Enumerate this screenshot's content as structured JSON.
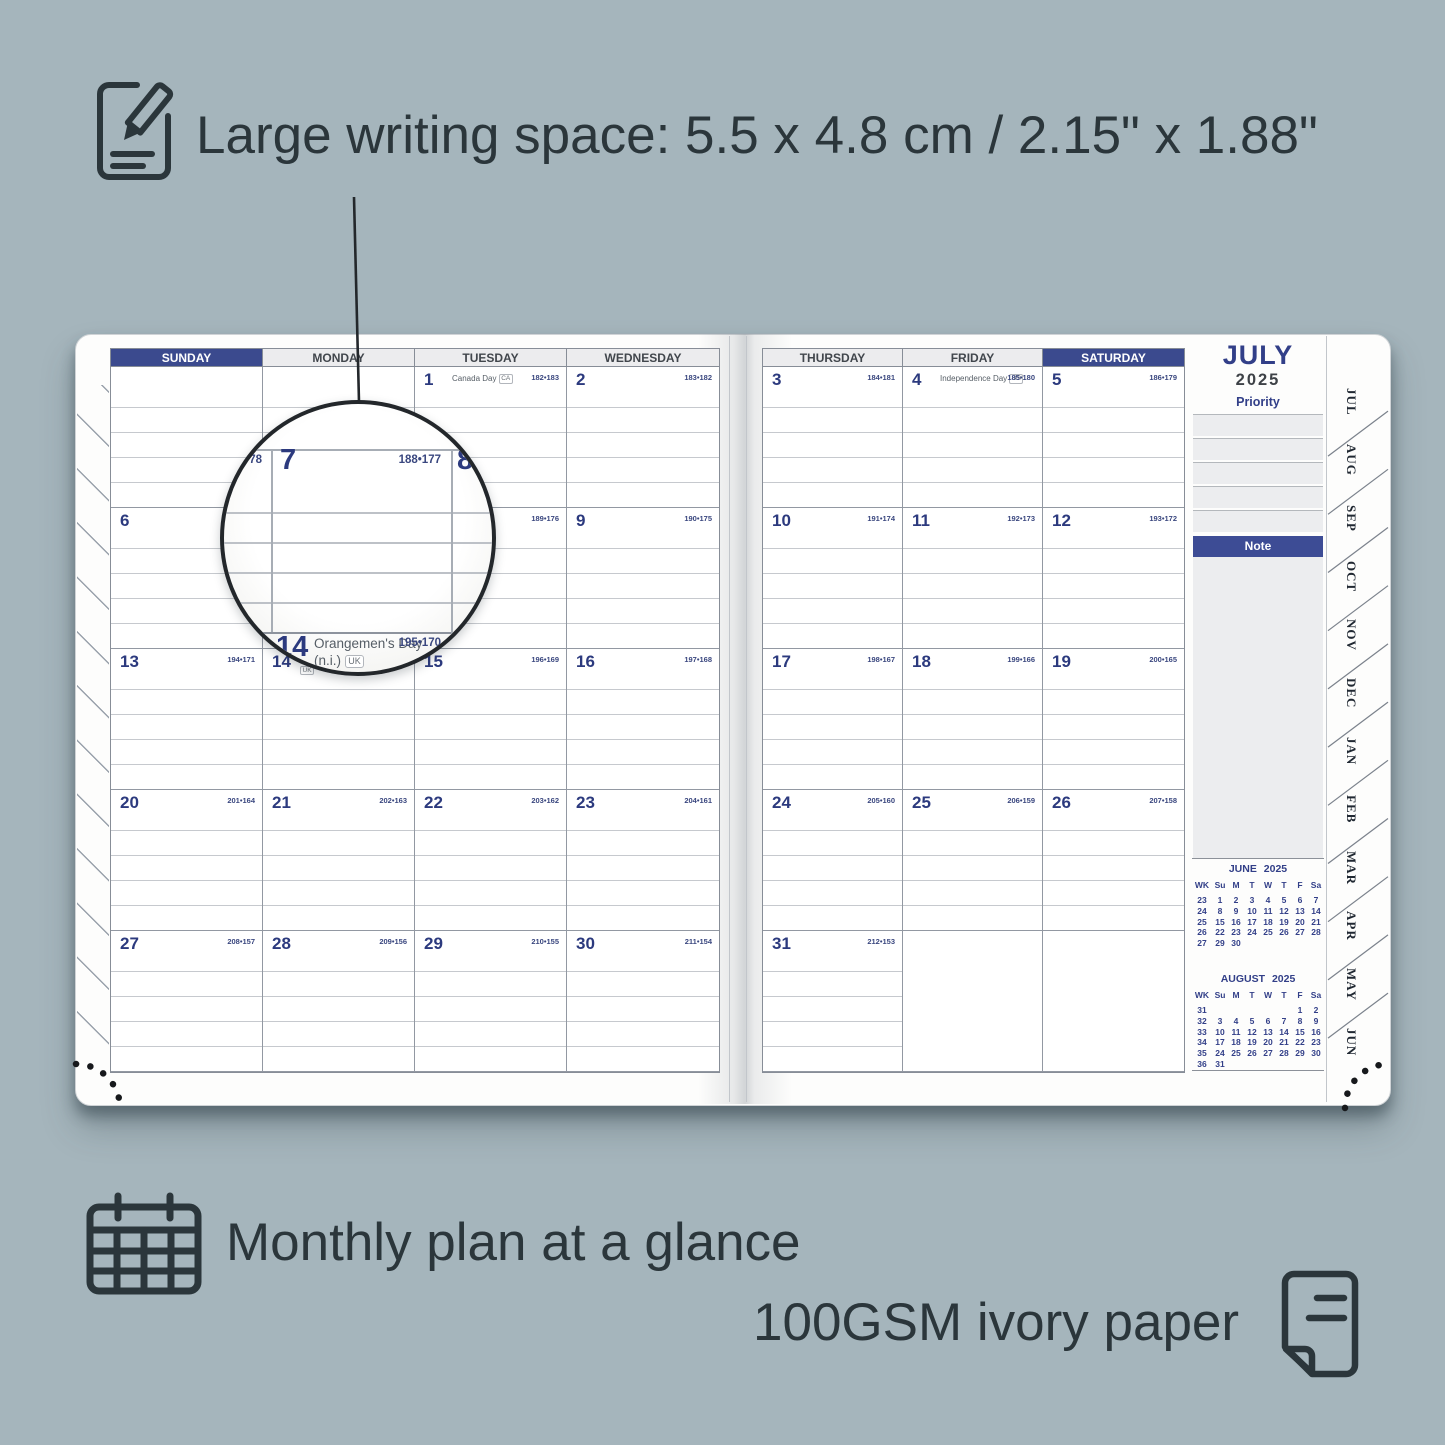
{
  "colors": {
    "background": "#a5b5bc",
    "annotation_text": "#2b363b",
    "navy_accent": "#3b4a8e",
    "day_number_navy": "#2c3a7e",
    "paper_white": "#fdfdfc"
  },
  "annotations": {
    "writing_space": {
      "icon": "note-pencil-icon",
      "text": "Large writing space: 5.5 x 4.8 cm / 2.15\" x 1.88\""
    },
    "monthly_plan": {
      "icon": "calendar-grid-icon",
      "text": "Monthly plan at a glance"
    },
    "paper": {
      "icon": "page-icon",
      "text": "100GSM ivory paper"
    }
  },
  "planner": {
    "left_page": {
      "headers": [
        {
          "label": "SUNDAY",
          "highlight": true
        },
        {
          "label": "MONDAY",
          "highlight": false
        },
        {
          "label": "TUESDAY",
          "highlight": false
        },
        {
          "label": "WEDNESDAY",
          "highlight": false
        }
      ],
      "weeks": [
        [
          null,
          null,
          {
            "day": "1",
            "holiday": "Canada Day",
            "tag": "CA",
            "doy": "182•183"
          },
          {
            "day": "2",
            "doy": "183•182"
          }
        ],
        [
          {
            "day": "6",
            "doy": "187•178"
          },
          {
            "day": "7",
            "doy": "188•177"
          },
          {
            "day": "8",
            "doy": "189•176"
          },
          {
            "day": "9",
            "doy": "190•175"
          }
        ],
        [
          {
            "day": "13",
            "doy": "194•171"
          },
          {
            "day": "14",
            "holiday": "Orangemen's Day (n.i.)",
            "tag": "UK",
            "doy": "195•170"
          },
          {
            "day": "15",
            "doy": "196•169"
          },
          {
            "day": "16",
            "doy": "197•168"
          }
        ],
        [
          {
            "day": "20",
            "doy": "201•164"
          },
          {
            "day": "21",
            "doy": "202•163"
          },
          {
            "day": "22",
            "doy": "203•162"
          },
          {
            "day": "23",
            "doy": "204•161"
          }
        ],
        [
          {
            "day": "27",
            "doy": "208•157"
          },
          {
            "day": "28",
            "doy": "209•156"
          },
          {
            "day": "29",
            "doy": "210•155"
          },
          {
            "day": "30",
            "doy": "211•154"
          }
        ]
      ]
    },
    "right_page": {
      "headers": [
        {
          "label": "THURSDAY",
          "highlight": false
        },
        {
          "label": "FRIDAY",
          "highlight": false
        },
        {
          "label": "SATURDAY",
          "highlight": true
        }
      ],
      "weeks": [
        [
          {
            "day": "3",
            "doy": "184•181"
          },
          {
            "day": "4",
            "holiday": "Independence Day",
            "tag": "US",
            "doy": "185•180"
          },
          {
            "day": "5",
            "doy": "186•179"
          }
        ],
        [
          {
            "day": "10",
            "doy": "191•174"
          },
          {
            "day": "11",
            "doy": "192•173"
          },
          {
            "day": "12",
            "doy": "193•172"
          }
        ],
        [
          {
            "day": "17",
            "doy": "198•167"
          },
          {
            "day": "18",
            "doy": "199•166"
          },
          {
            "day": "19",
            "doy": "200•165"
          }
        ],
        [
          {
            "day": "24",
            "doy": "205•160"
          },
          {
            "day": "25",
            "doy": "206•159"
          },
          {
            "day": "26",
            "doy": "207•158"
          }
        ],
        [
          {
            "day": "31",
            "doy": "212•153"
          },
          {
            "blank": true
          },
          {
            "blank": true
          }
        ]
      ]
    },
    "sidebar": {
      "month": "JULY",
      "year": "2025",
      "priority_label": "Priority",
      "note_label": "Note",
      "mini_calendars": [
        {
          "title": "JUNE 2025",
          "header": [
            "WK",
            "Su",
            "M",
            "T",
            "W",
            "T",
            "F",
            "Sa"
          ],
          "rows": [
            [
              "23",
              "1",
              "2",
              "3",
              "4",
              "5",
              "6",
              "7"
            ],
            [
              "24",
              "8",
              "9",
              "10",
              "11",
              "12",
              "13",
              "14"
            ],
            [
              "25",
              "15",
              "16",
              "17",
              "18",
              "19",
              "20",
              "21"
            ],
            [
              "26",
              "22",
              "23",
              "24",
              "25",
              "26",
              "27",
              "28"
            ],
            [
              "27",
              "29",
              "30",
              "",
              "",
              "",
              "",
              ""
            ]
          ]
        },
        {
          "title": "AUGUST 2025",
          "header": [
            "WK",
            "Su",
            "M",
            "T",
            "W",
            "T",
            "F",
            "Sa"
          ],
          "rows": [
            [
              "31",
              "",
              "",
              "",
              "",
              "",
              "1",
              "2"
            ],
            [
              "32",
              "3",
              "4",
              "5",
              "6",
              "7",
              "8",
              "9"
            ],
            [
              "33",
              "10",
              "11",
              "12",
              "13",
              "14",
              "15",
              "16"
            ],
            [
              "34",
              "17",
              "18",
              "19",
              "20",
              "21",
              "22",
              "23"
            ],
            [
              "35",
              "24",
              "25",
              "26",
              "27",
              "28",
              "29",
              "30"
            ],
            [
              "36",
              "31",
              "",
              "",
              "",
              "",
              "",
              ""
            ]
          ]
        }
      ]
    },
    "month_tabs": [
      "JUL",
      "AUG",
      "SEP",
      "OCT",
      "NOV",
      "DEC",
      "JAN",
      "FEB",
      "MAR",
      "APR",
      "MAY",
      "JUN"
    ],
    "magnifier": {
      "left_partial_doy": "78",
      "day_7": "7",
      "day_7_doy": "188•177",
      "day_8": "8",
      "day_14": "14",
      "day_14_holiday_line1": "Orangemen's Day",
      "day_14_holiday_line2": "(n.i.)",
      "day_14_tag": "UK",
      "day_14_doy": "195•170"
    }
  }
}
